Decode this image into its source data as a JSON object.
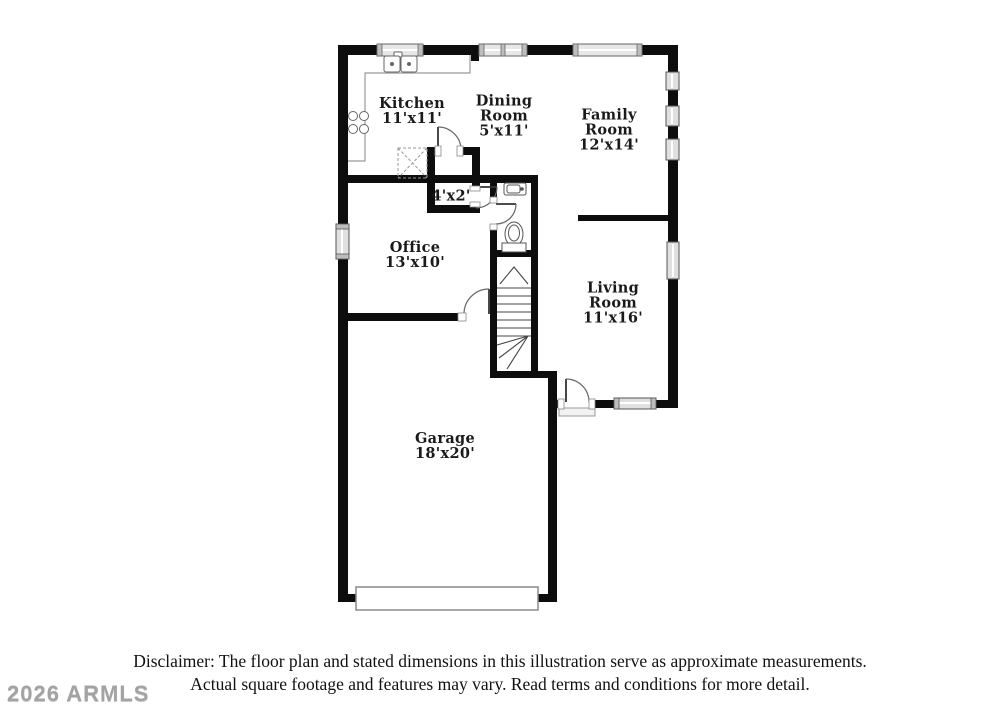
{
  "page": {
    "background": "#ffffff"
  },
  "watermark": {
    "text": "2026 ARMLS",
    "color": "#a3a3a3"
  },
  "disclaimer": {
    "line1": "Disclaimer: The floor plan and stated dimensions in this illustration serve as approximate measurements.",
    "line2": "Actual square footage and features may vary. Read terms and conditions for more detail."
  },
  "floor_plan": {
    "rooms": [
      {
        "id": "kitchen",
        "name": "Kitchen",
        "dims": "11'x11'"
      },
      {
        "id": "dining-room",
        "name": "Dining Room",
        "dims": "5'x11'"
      },
      {
        "id": "family-room",
        "name": "Family Room",
        "dims": "12'x14'"
      },
      {
        "id": "closet",
        "name": "",
        "dims": "4'x2'"
      },
      {
        "id": "office",
        "name": "Office",
        "dims": "13'x10'"
      },
      {
        "id": "living-room",
        "name": "Living Room",
        "dims": "11'x16'"
      },
      {
        "id": "garage",
        "name": "Garage",
        "dims": "18'x20'"
      }
    ],
    "fixtures": [
      "kitchen-sink",
      "cooktop",
      "pantry-cabinet",
      "powder-sink",
      "toilet",
      "staircase",
      "garage-door",
      "entry-door",
      "windows"
    ],
    "colors": {
      "wall": "#0d0d0d",
      "line": "#555555",
      "window_fill": "#e6e6e6",
      "text": "#1a1a1a"
    }
  }
}
